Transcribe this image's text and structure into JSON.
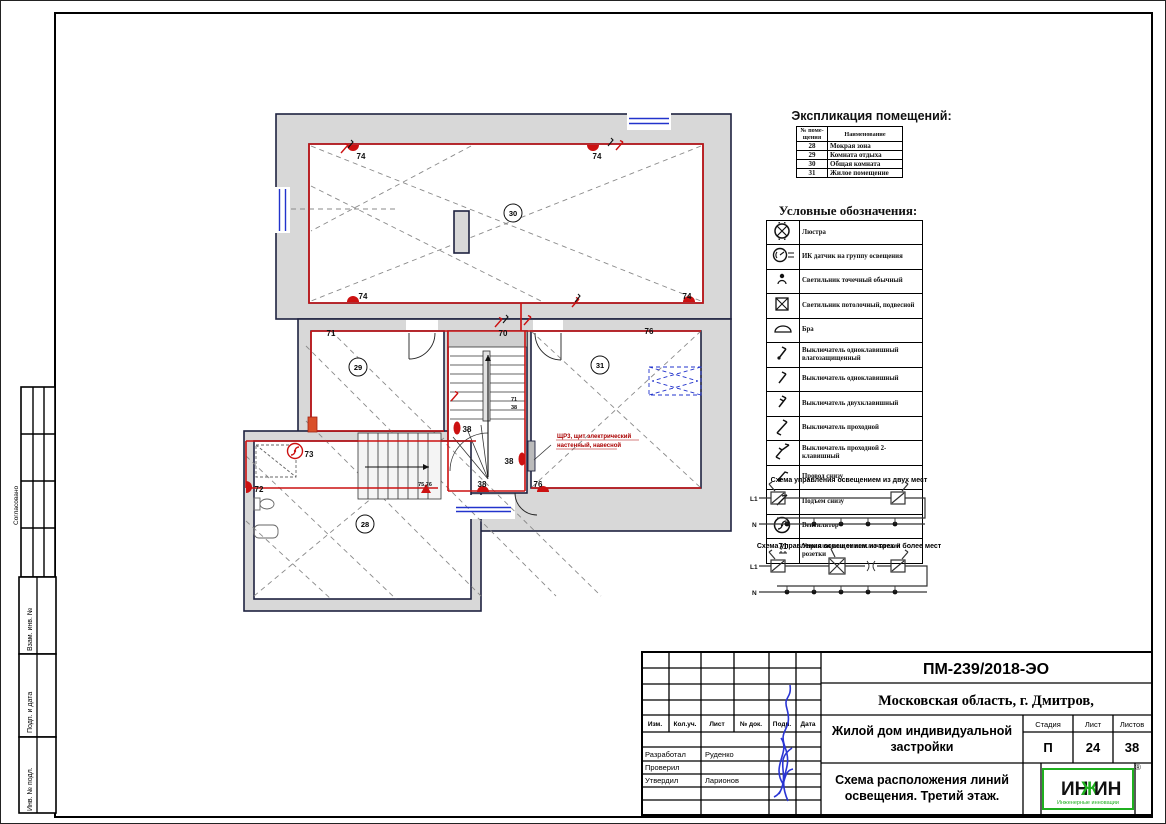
{
  "sheet": {
    "doc_number": "ПМ-239/2018-ЭО",
    "location": "Московская область, г. Дмитров,",
    "project_line1": "Жилой дом индивидуальной",
    "project_line2": "застройки",
    "title_line1": "Схема расположения линий",
    "title_line2": "освещения.  Третий этаж.",
    "stage_label": "Стадия",
    "sheet_label": "Лист",
    "sheets_label": "Листов",
    "stage": "П",
    "sheet_num": "24",
    "sheets_total": "38",
    "stamp_cols": [
      "Изм.",
      "Кол.уч.",
      "Лист",
      "№ док.",
      "Подп.",
      "Дата"
    ],
    "roles": [
      {
        "role": "Разработал",
        "name": "Руденко"
      },
      {
        "role": "Проверил",
        "name": ""
      },
      {
        "role": "Утвердил",
        "name": "Ларионов"
      }
    ],
    "logo": {
      "p1": "ИН",
      "zh": "Ж",
      "p2": "ИН",
      "sub": "Инженерные инновации",
      "reg": "®"
    },
    "frame_labels": {
      "approved": "Согласовано",
      "vzam": "Взам. инв. №",
      "podp": "Подп. и дата",
      "inv": "Инв. № подл."
    }
  },
  "explication": {
    "title": "Экспликация помещений:",
    "header_num": "№ поме- щения",
    "header_name": "Наименование",
    "rows": [
      {
        "num": "28",
        "name": "Мокрая зона"
      },
      {
        "num": "29",
        "name": "Комната отдыха"
      },
      {
        "num": "30",
        "name": "Общая комната"
      },
      {
        "num": "31",
        "name": "Жилое помещение"
      }
    ]
  },
  "legend": {
    "title": "Условные обозначения:",
    "items": [
      {
        "icon": "chandelier-icon",
        "label": "Люстра"
      },
      {
        "icon": "ir-sensor-icon",
        "label": "ИК датчик на группу освещения"
      },
      {
        "icon": "spot-light-icon",
        "label": "Светильник точечный обычный"
      },
      {
        "icon": "pendant-light-icon",
        "label": "Светильник потолочный, подвесной"
      },
      {
        "icon": "sconce-icon",
        "label": "Бра"
      },
      {
        "icon": "switch-single-waterproof-icon",
        "label": "Выключатель одноклавишный влагозащищенный"
      },
      {
        "icon": "switch-single-icon",
        "label": "Выключатель одноклавишный"
      },
      {
        "icon": "switch-double-icon",
        "label": "Выключатель двухклавишный"
      },
      {
        "icon": "switch-pass-icon",
        "label": "Выключатель проходной"
      },
      {
        "icon": "switch-pass-double-icon",
        "label": "Выключатель проходной 2-клавишный"
      },
      {
        "icon": "wire-from-below-icon",
        "label": "Провод снизу"
      },
      {
        "icon": "rise-up-icon",
        "label": "Подъем снизу"
      },
      {
        "icon": "fan-icon",
        "label": "Вентилятор"
      },
      {
        "icon": "controlled-socket-icon",
        "label": "Управляемые от выключателей розетки",
        "symbol": "71"
      }
    ]
  },
  "schematics": {
    "two_places_title": "Схема управления освещением из двух мест",
    "multi_places_title": "Схема управления освещением из трех и более мест",
    "l1_label": "L1",
    "n_label": "N"
  },
  "plan": {
    "rooms": [
      {
        "id": "30"
      },
      {
        "id": "29"
      },
      {
        "id": "31"
      },
      {
        "id": "28"
      }
    ],
    "markers": [
      "74",
      "74",
      "74",
      "74",
      "71",
      "70",
      "76",
      "73",
      "72",
      "38",
      "38",
      "38",
      "76",
      "71",
      "38",
      "75,76"
    ],
    "panel_note_line1": "ЩР3, щит электрический",
    "panel_note_line2": "настенный, навесной"
  },
  "colors": {
    "wall_fill": "#d8d8d8",
    "outline": "#1e2240",
    "wiring_red": "#cc1111",
    "window_blue": "#2233cc",
    "logo_green": "#1faf1f",
    "signature_blue": "#2a35d4"
  }
}
